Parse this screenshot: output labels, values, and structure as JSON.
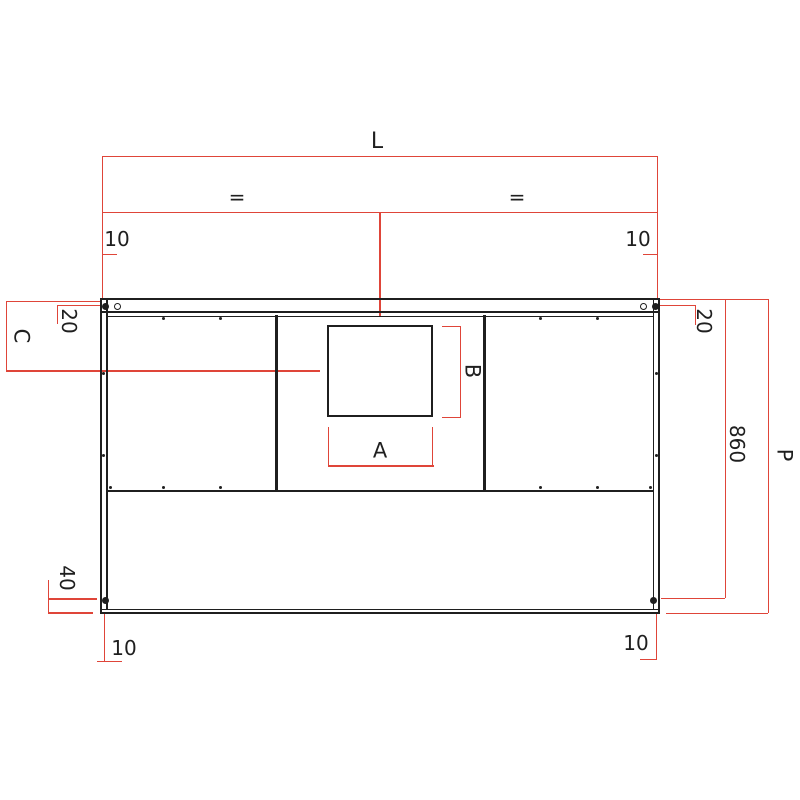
{
  "colors": {
    "dimension_red": "#df4539",
    "structure_black": "#1f1f1f",
    "background": "#ffffff"
  },
  "dimensions": {
    "length_label": "L",
    "equal_left": "=",
    "equal_right": "=",
    "top_left_offset": "10",
    "top_right_offset": "10",
    "left_inset": "20",
    "right_inset": "20",
    "opening_offset_label": "C",
    "opening_width_label": "A",
    "opening_height_label": "B",
    "inner_height": "860",
    "total_height_label": "P",
    "bottom_rail_height": "40",
    "bottom_left_offset": "10",
    "bottom_right_offset": "10"
  }
}
